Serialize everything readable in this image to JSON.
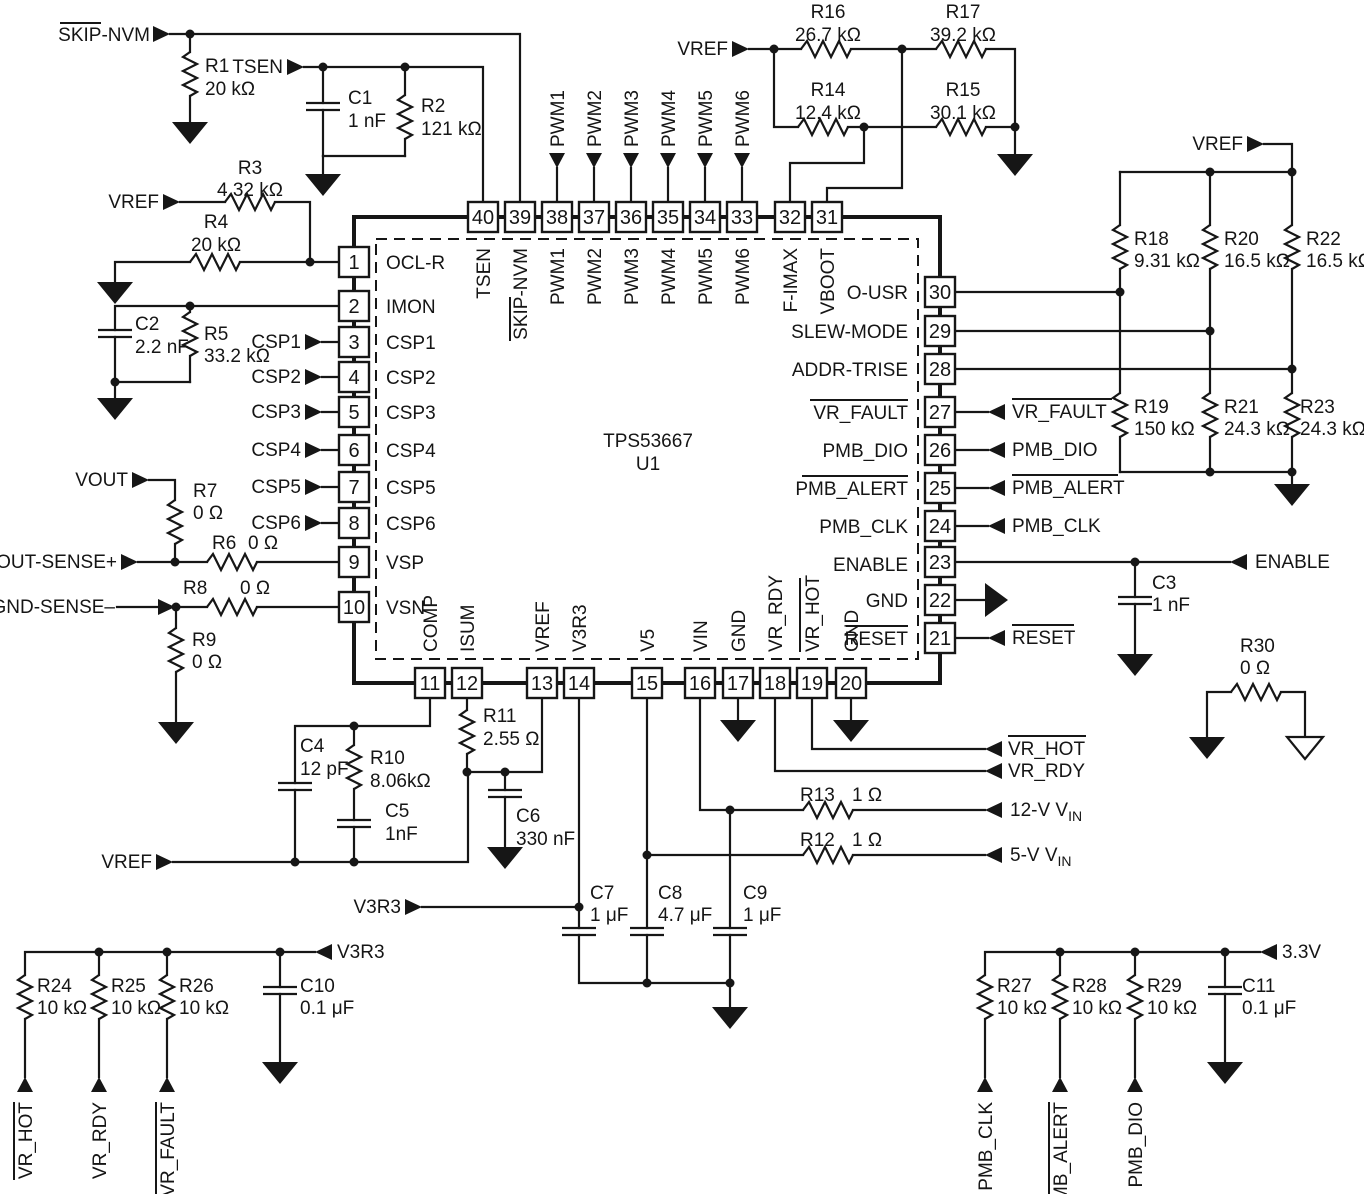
{
  "chip": {
    "part": "TPS53667",
    "refdes": "U1",
    "pins_left": [
      {
        "num": "1",
        "name": "OCL-R"
      },
      {
        "num": "2",
        "name": "IMON"
      },
      {
        "num": "3",
        "name": "CSP1"
      },
      {
        "num": "4",
        "name": "CSP2"
      },
      {
        "num": "5",
        "name": "CSP3"
      },
      {
        "num": "6",
        "name": "CSP4"
      },
      {
        "num": "7",
        "name": "CSP5"
      },
      {
        "num": "8",
        "name": "CSP6"
      },
      {
        "num": "9",
        "name": "VSP"
      },
      {
        "num": "10",
        "name": "VSN"
      }
    ],
    "pins_right": [
      {
        "num": "30",
        "name": "O-USR"
      },
      {
        "num": "29",
        "name": "SLEW-MODE"
      },
      {
        "num": "28",
        "name": "ADDR-TRISE"
      },
      {
        "num": "27",
        "name": "VR_FAULT"
      },
      {
        "num": "26",
        "name": "PMB_DIO"
      },
      {
        "num": "25",
        "name": "PMB_ALERT"
      },
      {
        "num": "24",
        "name": "PMB_CLK"
      },
      {
        "num": "23",
        "name": "ENABLE"
      },
      {
        "num": "22",
        "name": "GND"
      },
      {
        "num": "21",
        "name": "RESET"
      }
    ],
    "pins_top": [
      {
        "num": "40",
        "name": "TSEN"
      },
      {
        "num": "39",
        "name": "SKIP-NVM"
      },
      {
        "num": "38",
        "name": "PWM1"
      },
      {
        "num": "37",
        "name": "PWM2"
      },
      {
        "num": "36",
        "name": "PWM3"
      },
      {
        "num": "35",
        "name": "PWM4"
      },
      {
        "num": "34",
        "name": "PWM5"
      },
      {
        "num": "33",
        "name": "PWM6"
      },
      {
        "num": "32",
        "name": "F-IMAX"
      },
      {
        "num": "31",
        "name": "VBOOT"
      }
    ],
    "pins_bottom": [
      {
        "num": "11",
        "name": "COMP"
      },
      {
        "num": "12",
        "name": "ISUM"
      },
      {
        "num": "13",
        "name": "VREF"
      },
      {
        "num": "14",
        "name": "V3R3"
      },
      {
        "num": "15",
        "name": "V5"
      },
      {
        "num": "16",
        "name": "VIN"
      },
      {
        "num": "17",
        "name": "GND"
      },
      {
        "num": "18",
        "name": "VR_RDY"
      },
      {
        "num": "19",
        "name": "VR_HOT"
      },
      {
        "num": "20",
        "name": "GND"
      }
    ]
  },
  "components": {
    "r1": {
      "ref": "R1",
      "value": "20 kΩ"
    },
    "r2": {
      "ref": "R2",
      "value": "121 kΩ"
    },
    "r3": {
      "ref": "R3",
      "value": "4.32 kΩ"
    },
    "r4": {
      "ref": "R4",
      "value": "20 kΩ"
    },
    "r5": {
      "ref": "R5",
      "value": "33.2 kΩ"
    },
    "r6": {
      "ref": "R6",
      "value": "0 Ω"
    },
    "r7": {
      "ref": "R7",
      "value": "0 Ω"
    },
    "r8": {
      "ref": "R8",
      "value": "0 Ω"
    },
    "r9": {
      "ref": "R9",
      "value": "0 Ω"
    },
    "r10": {
      "ref": "R10",
      "value": "8.06kΩ"
    },
    "r11": {
      "ref": "R11",
      "value": "2.55 Ω"
    },
    "r12": {
      "ref": "R12",
      "value": "1 Ω"
    },
    "r13": {
      "ref": "R13",
      "value": "1 Ω"
    },
    "r14": {
      "ref": "R14",
      "value": "12.4 kΩ"
    },
    "r15": {
      "ref": "R15",
      "value": "30.1 kΩ"
    },
    "r16": {
      "ref": "R16",
      "value": "26.7 kΩ"
    },
    "r17": {
      "ref": "R17",
      "value": "39.2 kΩ"
    },
    "r18": {
      "ref": "R18",
      "value": "9.31 kΩ"
    },
    "r19": {
      "ref": "R19",
      "value": "150 kΩ"
    },
    "r20": {
      "ref": "R20",
      "value": "16.5 kΩ"
    },
    "r21": {
      "ref": "R21",
      "value": "24.3 kΩ"
    },
    "r22": {
      "ref": "R22",
      "value": "16.5 kΩ"
    },
    "r23": {
      "ref": "R23",
      "value": "24.3 kΩ"
    },
    "r24": {
      "ref": "R24",
      "value": "10 kΩ"
    },
    "r25": {
      "ref": "R25",
      "value": "10 kΩ"
    },
    "r26": {
      "ref": "R26",
      "value": "10 kΩ"
    },
    "r27": {
      "ref": "R27",
      "value": "10 kΩ"
    },
    "r28": {
      "ref": "R28",
      "value": "10 kΩ"
    },
    "r29": {
      "ref": "R29",
      "value": "10 kΩ"
    },
    "r30": {
      "ref": "R30",
      "value": "0 Ω"
    },
    "c1": {
      "ref": "C1",
      "value": "1 nF"
    },
    "c2": {
      "ref": "C2",
      "value": "2.2 nF"
    },
    "c3": {
      "ref": "C3",
      "value": "1 nF"
    },
    "c4": {
      "ref": "C4",
      "value": "12 pF"
    },
    "c5": {
      "ref": "C5",
      "value": "1nF"
    },
    "c6": {
      "ref": "C6",
      "value": "330 nF"
    },
    "c7": {
      "ref": "C7",
      "value": "1 μF"
    },
    "c8": {
      "ref": "C8",
      "value": "4.7 μF"
    },
    "c9": {
      "ref": "C9",
      "value": "1 μF"
    },
    "c10": {
      "ref": "C10",
      "value": "0.1 μF"
    },
    "c11": {
      "ref": "C11",
      "value": "0.1 μF"
    }
  },
  "nets": {
    "skip_nvm": "SKIP-NVM",
    "tsen": "TSEN",
    "vref": "VREF",
    "vout": "VOUT",
    "vout_sense_p": "VOUT-SENSE+",
    "gnd_sense_n": "GND-SENSE–",
    "csp1": "CSP1",
    "csp2": "CSP2",
    "csp3": "CSP3",
    "csp4": "CSP4",
    "csp5": "CSP5",
    "csp6": "CSP6",
    "pwm1": "PWM1",
    "pwm2": "PWM2",
    "pwm3": "PWM3",
    "pwm4": "PWM4",
    "pwm5": "PWM5",
    "pwm6": "PWM6",
    "v3r3": "V3R3",
    "enable": "ENABLE",
    "vr_fault": "VR_FAULT",
    "pmb_dio": "PMB_DIO",
    "pmb_alert": "PMB_ALERT",
    "pmb_clk": "PMB_CLK",
    "reset": "RESET",
    "vr_hot": "VR_HOT",
    "vr_rdy": "VR_RDY",
    "vin12": {
      "base": "12-V V",
      "sub": "IN"
    },
    "vin5": {
      "base": "5-V V",
      "sub": "IN"
    },
    "rail_3v3": "3.3V"
  }
}
